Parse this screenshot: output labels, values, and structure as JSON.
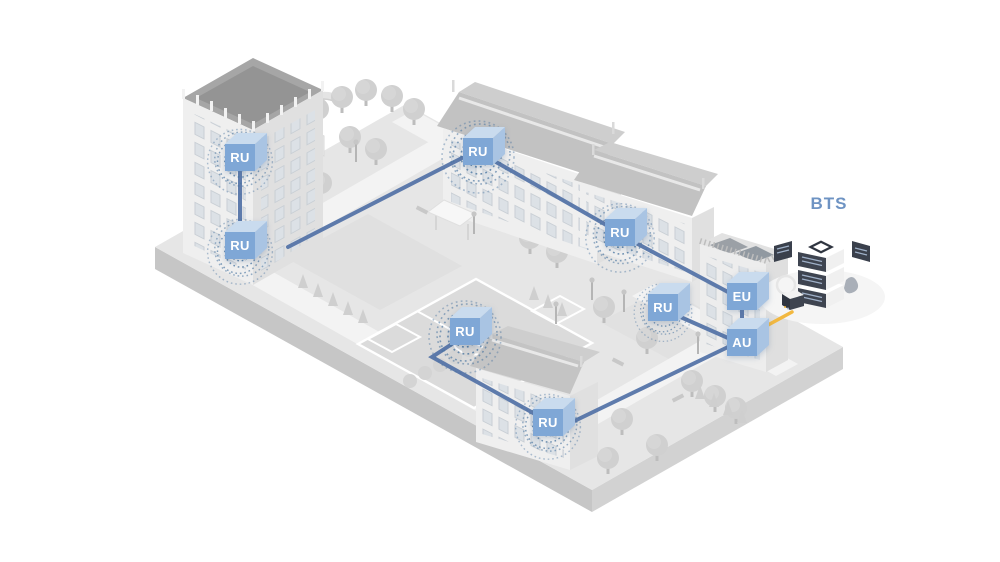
{
  "diagram": {
    "bts_label": "BTS",
    "nodes": [
      {
        "id": "ru-1",
        "label": "RU"
      },
      {
        "id": "ru-2",
        "label": "RU"
      },
      {
        "id": "ru-3",
        "label": "RU"
      },
      {
        "id": "ru-4",
        "label": "RU"
      },
      {
        "id": "ru-5",
        "label": "RU"
      },
      {
        "id": "ru-6",
        "label": "RU"
      },
      {
        "id": "ru-7",
        "label": "RU"
      },
      {
        "id": "eu",
        "label": "EU"
      },
      {
        "id": "au",
        "label": "AU"
      }
    ],
    "links": [
      [
        "ru-1",
        "ru-2"
      ],
      [
        "ru-2",
        "ru-3"
      ],
      [
        "ru-3",
        "ru-4"
      ],
      [
        "ru-4",
        "eu"
      ],
      [
        "eu",
        "au"
      ],
      [
        "ru-5",
        "au"
      ],
      [
        "ru-6",
        "ru-7"
      ],
      [
        "ru-7",
        "au"
      ],
      [
        "au",
        "bts"
      ]
    ]
  },
  "colors": {
    "connection_line": "#5574A8",
    "bts_link_line": "#F2B840",
    "node_front": "#7FA7D6",
    "node_top": "#C9DBEE",
    "node_side": "#A9C4E3",
    "node_label_text": "#FFFFFF",
    "bts_label_text": "#6E93C3",
    "wave": "#47739F"
  }
}
